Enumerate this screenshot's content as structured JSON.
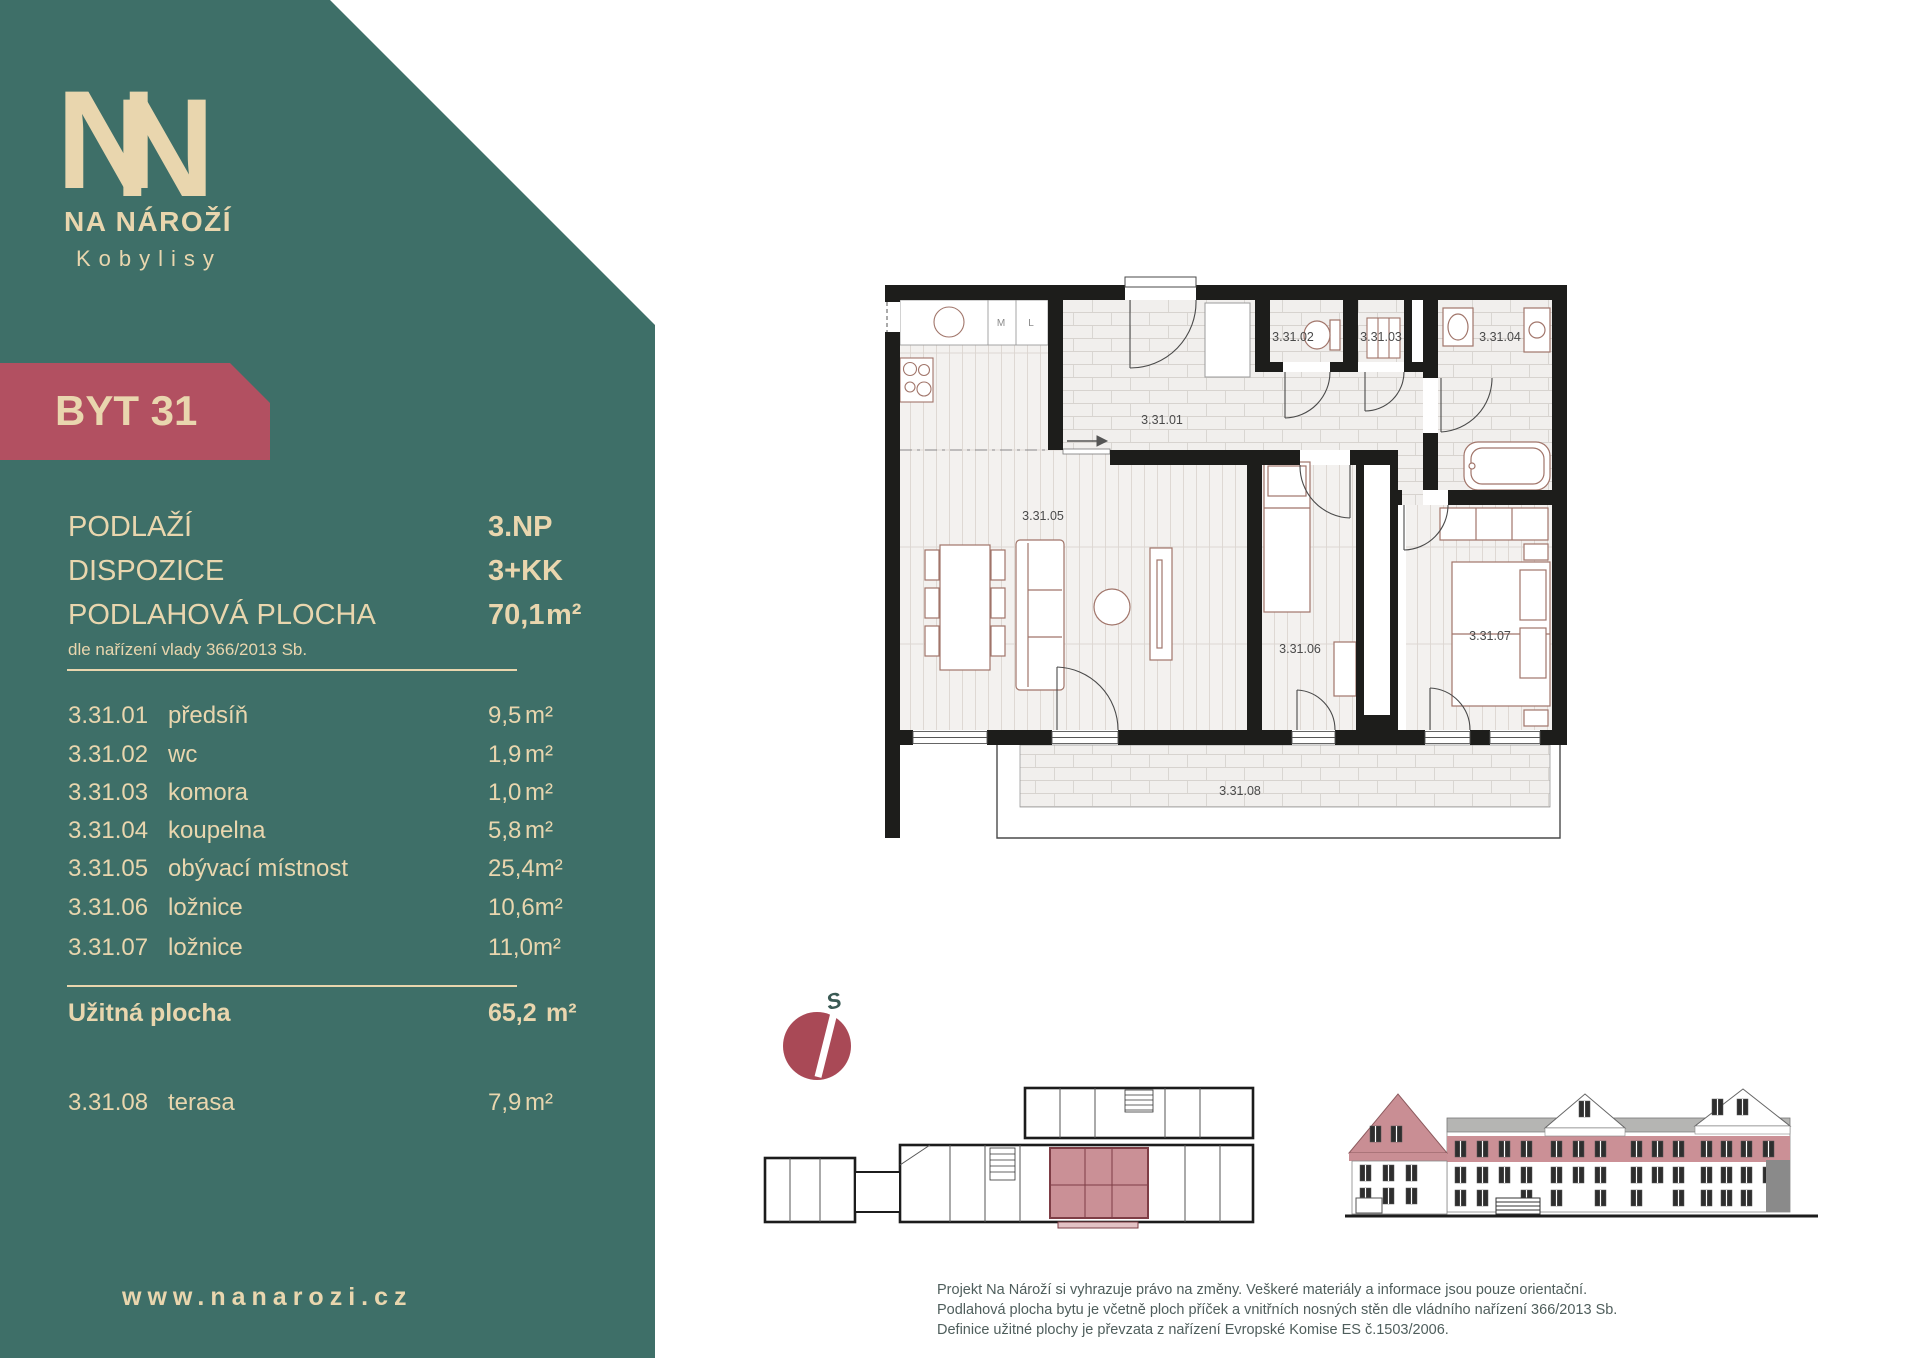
{
  "brand": {
    "monogram": [
      "N",
      "N"
    ],
    "name": "NA NÁROŽÍ",
    "subtitle": "Kobylisy",
    "website": "www.nanarozi.cz"
  },
  "badge": {
    "label": "BYT 31"
  },
  "details": {
    "rows": [
      {
        "label": "PODLAŽÍ",
        "value": "3.NP",
        "unit": ""
      },
      {
        "label": "DISPOZICE",
        "value": "3+KK",
        "unit": ""
      },
      {
        "label": "PODLAHOVÁ PLOCHA",
        "value": "70,1",
        "unit": "m²"
      }
    ],
    "note": "dle nařízení vlady 366/2013 Sb."
  },
  "rooms": [
    {
      "code": "3.31.01",
      "name": "předsíň",
      "area": "9,5",
      "unit": "m²"
    },
    {
      "code": "3.31.02",
      "name": "wc",
      "area": "1,9",
      "unit": "m²"
    },
    {
      "code": "3.31.03",
      "name": "komora",
      "area": "1,0",
      "unit": "m²"
    },
    {
      "code": "3.31.04",
      "name": "koupelna",
      "area": "5,8",
      "unit": "m²"
    },
    {
      "code": "3.31.05",
      "name": "obývací místnost",
      "area": "25,4",
      "unit": "m²"
    },
    {
      "code": "3.31.06",
      "name": "ložnice",
      "area": "10,6",
      "unit": "m²"
    },
    {
      "code": "3.31.07",
      "name": "ložnice",
      "area": "11,0",
      "unit": "m²"
    }
  ],
  "total": {
    "label": "Užitná plocha",
    "area": "65,2",
    "unit": "m²"
  },
  "terrace": {
    "code": "3.31.08",
    "name": "terasa",
    "area": "7,9",
    "unit": "m²"
  },
  "plan": {
    "labels": [
      "3.31.01",
      "3.31.02",
      "3.31.03",
      "3.31.04",
      "3.31.05",
      "3.31.06",
      "3.31.07",
      "3.31.08"
    ],
    "kitchen": {
      "m": "M",
      "l": "L"
    },
    "compass": "S"
  },
  "disclaimer": {
    "lines": [
      "Projekt Na Nároží si vyhrazuje právo na změny. Veškeré materiály a informace jsou pouze orientační.",
      "Podlahová plocha bytu je včetně ploch příček a vnitřních nosných stěn dle vládního nařízení 366/2013 Sb.",
      "Definice užitné plochy je převzata z nařízení Evropské Komise ES č.1503/2006."
    ]
  },
  "colors": {
    "teal": "#3E6F68",
    "cream": "#E9D6AE",
    "badge_red": "#B25061",
    "highlight_pink": "#CA9096",
    "plan_wall": "#1D1D1B",
    "compass_red": "#A94956"
  }
}
